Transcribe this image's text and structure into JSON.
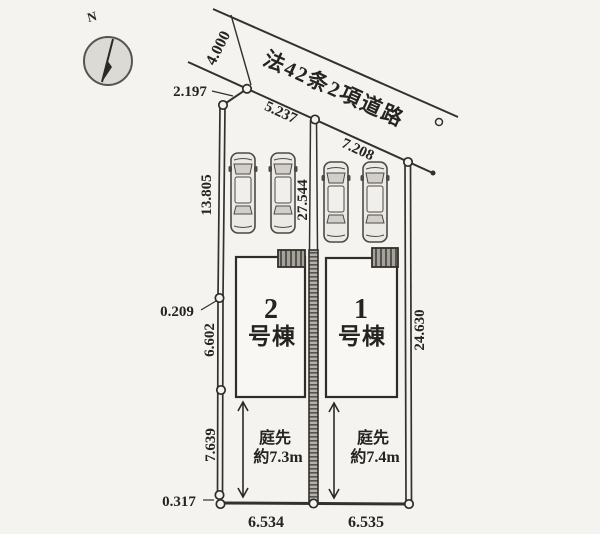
{
  "title": "区画図",
  "colors": {
    "paper": "#f4f3ef",
    "ink": "#34312d",
    "text": "#262420",
    "car_body": "#eceae5",
    "glass": "#d2cfca",
    "divider_fill": "#b3b0aa",
    "porch_fill": "#a5a29c",
    "compass_fill": "#dcdad5"
  },
  "compass": {
    "label": "N"
  },
  "road": {
    "name": "法42条2項道路",
    "width": "4.000"
  },
  "dims": {
    "d2197": "2.197",
    "d5237": "5.237",
    "d7208": "7.208",
    "d13805": "13.805",
    "d0209": "0.209",
    "d6602": "6.602",
    "d7639": "7.639",
    "d0317": "0.317",
    "d6534": "6.534",
    "d6535": "6.535",
    "d27544": "27.544",
    "d24630": "24.630"
  },
  "lots": [
    {
      "no": "2",
      "suffix": "号棟",
      "garden_word": "庭先",
      "garden_size": "約7.3m"
    },
    {
      "no": "1",
      "suffix": "号棟",
      "garden_word": "庭先",
      "garden_size": "約7.4m"
    }
  ]
}
